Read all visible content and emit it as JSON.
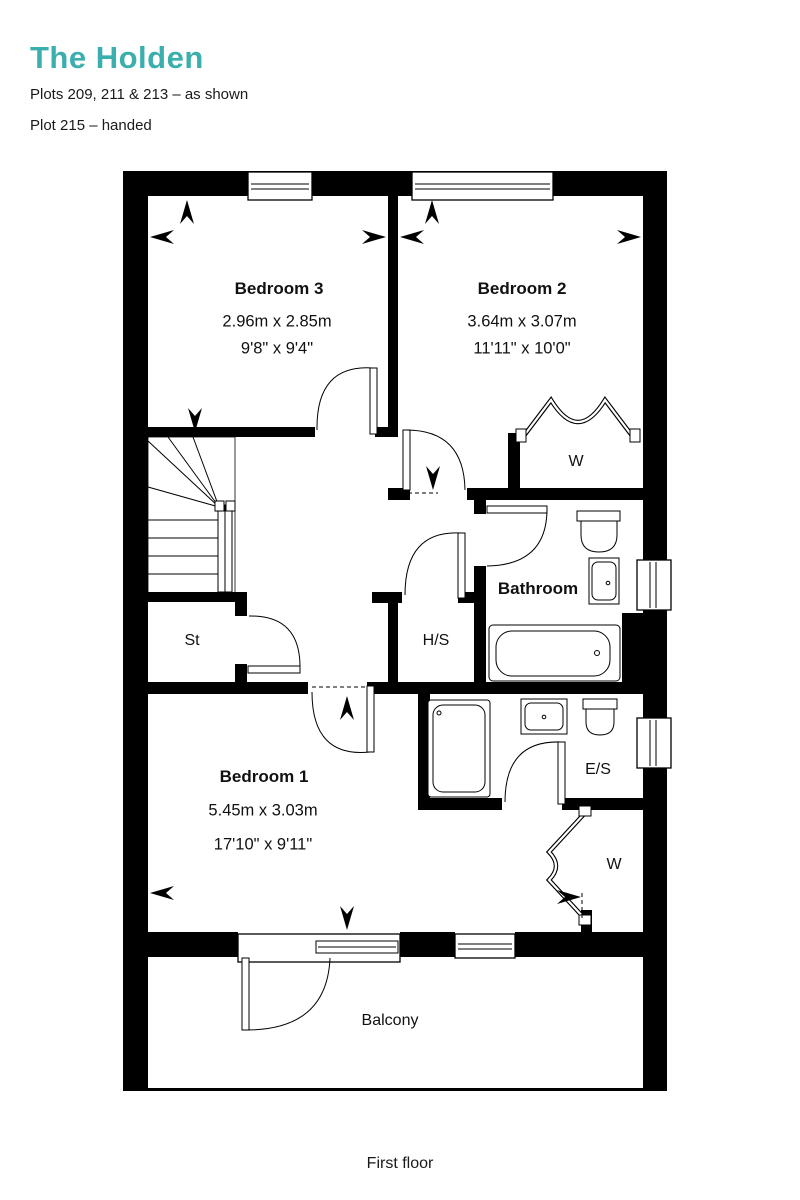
{
  "header": {
    "title": "The Holden",
    "subtitle1": "Plots 209, 211 & 213 – as shown",
    "subtitle2": "Plot 215 – handed"
  },
  "colors": {
    "accent": "#3BAFAD",
    "walls": "#000000",
    "background": "#ffffff"
  },
  "rooms": {
    "bedroom3": {
      "name": "Bedroom 3",
      "metric": "2.96m x 2.85m",
      "imperial": "9'8\" x 9'4\""
    },
    "bedroom2": {
      "name": "Bedroom 2",
      "metric": "3.64m x 3.07m",
      "imperial": "11'11\" x 10'0\""
    },
    "bedroom1": {
      "name": "Bedroom 1",
      "metric": "5.45m x 3.03m",
      "imperial": "17'10\" x 9'11\""
    },
    "bathroom": {
      "name": "Bathroom"
    },
    "ensuite": {
      "name": "E/S"
    },
    "storage": {
      "name": "St"
    },
    "hot_water_store": {
      "name": "H/S"
    },
    "wardrobe_bedroom2": {
      "name": "W"
    },
    "wardrobe_bedroom1": {
      "name": "W"
    },
    "balcony": {
      "name": "Balcony"
    }
  },
  "footer": {
    "floor_label": "First floor"
  }
}
